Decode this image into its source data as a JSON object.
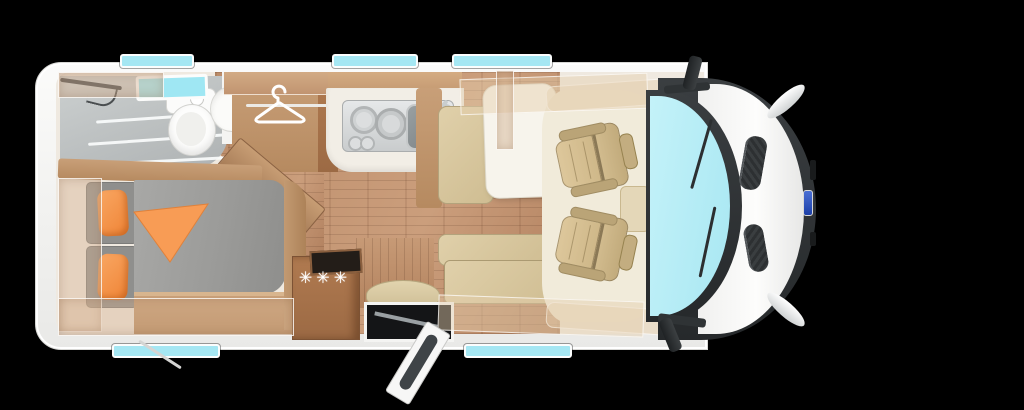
{
  "scene": {
    "width": 1024,
    "height": 410,
    "type": "motorhome-floorplan-top-view"
  },
  "theme": {
    "bg": "#000000",
    "bodywhite": "#f4f4f2",
    "dark": "#33373a",
    "windshield": "#b5edf6",
    "glass": "#a5e7f3",
    "woodfloor": "#bb8c69",
    "wood": "#c89f78",
    "cushion": "#cfbd92",
    "cushionL": "#e0d0aa",
    "mattress": "#9a9a98",
    "orange": "#f6974e",
    "shower": "#bfc3c4",
    "cream": "#efe9e0",
    "cabfloor": "#f1ebda"
  },
  "floorplan": {
    "orientation": "cab-on-right-rear-on-left",
    "areas": {
      "bathroom": {
        "fixtures": [
          "shower",
          "toilet",
          "washbasin",
          "rooflight"
        ]
      },
      "wardrobe": {
        "icon": "clothes-hanger"
      },
      "kitchen": {
        "fixtures": [
          "three-burner-hob",
          "sink",
          "faucet"
        ]
      },
      "refrigerator": {
        "freezer_symbol": "✳✳✳"
      },
      "dinette": {
        "fixtures": [
          "table",
          "forward-bench",
          "side-bench"
        ]
      },
      "bedroom": {
        "fixtures": [
          "double-bed",
          "orange-pillows",
          "orange-blanket"
        ]
      },
      "cab": {
        "fixtures": [
          "driver-swivel-seat",
          "passenger-swivel-seat",
          "windshield",
          "wing-mirrors"
        ]
      },
      "entry": {
        "fixtures": [
          "open-entry-door",
          "step-well",
          "stool"
        ]
      }
    },
    "side_window_count": 5,
    "rooflight_count": 1
  }
}
